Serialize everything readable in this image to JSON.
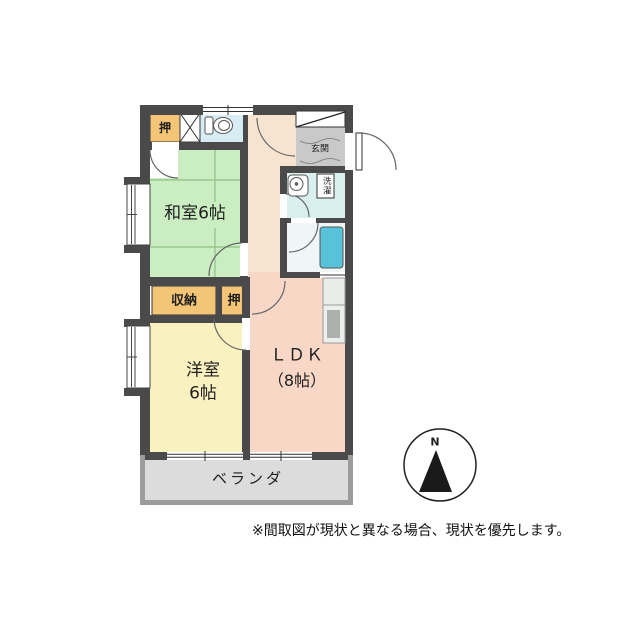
{
  "floor_plan": {
    "wall_color": "#4A4A4A",
    "veranda_wall_color": "#9C9C9C",
    "rooms": {
      "washitsu": {
        "label": "和室6帖",
        "color": "#CBEDC2",
        "tatami_line_color": "#8FBF85"
      },
      "yoshitsu": {
        "label_line1": "洋室",
        "label_line2": "6帖",
        "color": "#FAF1C0"
      },
      "ldk": {
        "label_line1": "ＬＤＫ",
        "label_line2": "（8帖）",
        "color": "#F8D7C6"
      },
      "closet_top": {
        "label": "押",
        "color": "#F4C577"
      },
      "storage": {
        "label": "収納",
        "color": "#F4C577"
      },
      "closet_mid": {
        "label": "押",
        "color": "#F4C577"
      },
      "entrance": {
        "label": "玄関",
        "color": "#C9C9C9"
      },
      "laundry": {
        "label": "洗濯"
      },
      "veranda": {
        "label": "ベランダ",
        "color": "#DCDCDC"
      },
      "hallway": {
        "color": "#F7E4D0"
      },
      "toilet_room": {
        "color": "#D7EDF3"
      },
      "washroom": {
        "color": "#D9F0EF"
      },
      "bathroom": {
        "color": "#F0F6F6",
        "tub_color": "#57C3DB"
      }
    },
    "icons": {
      "toilet": "toilet-icon",
      "sink": "sink-icon",
      "bathtub": "bathtub-icon",
      "shoe_cabinet": "shoe-cabinet-icon",
      "pipe_space": "pipe-space-x-icon",
      "kitchen_counter": "kitchen-counter-icon"
    },
    "compass": {
      "label": "N"
    }
  },
  "footer": {
    "disclaimer": "※間取図が現状と異なる場合、現状を優先します。"
  }
}
